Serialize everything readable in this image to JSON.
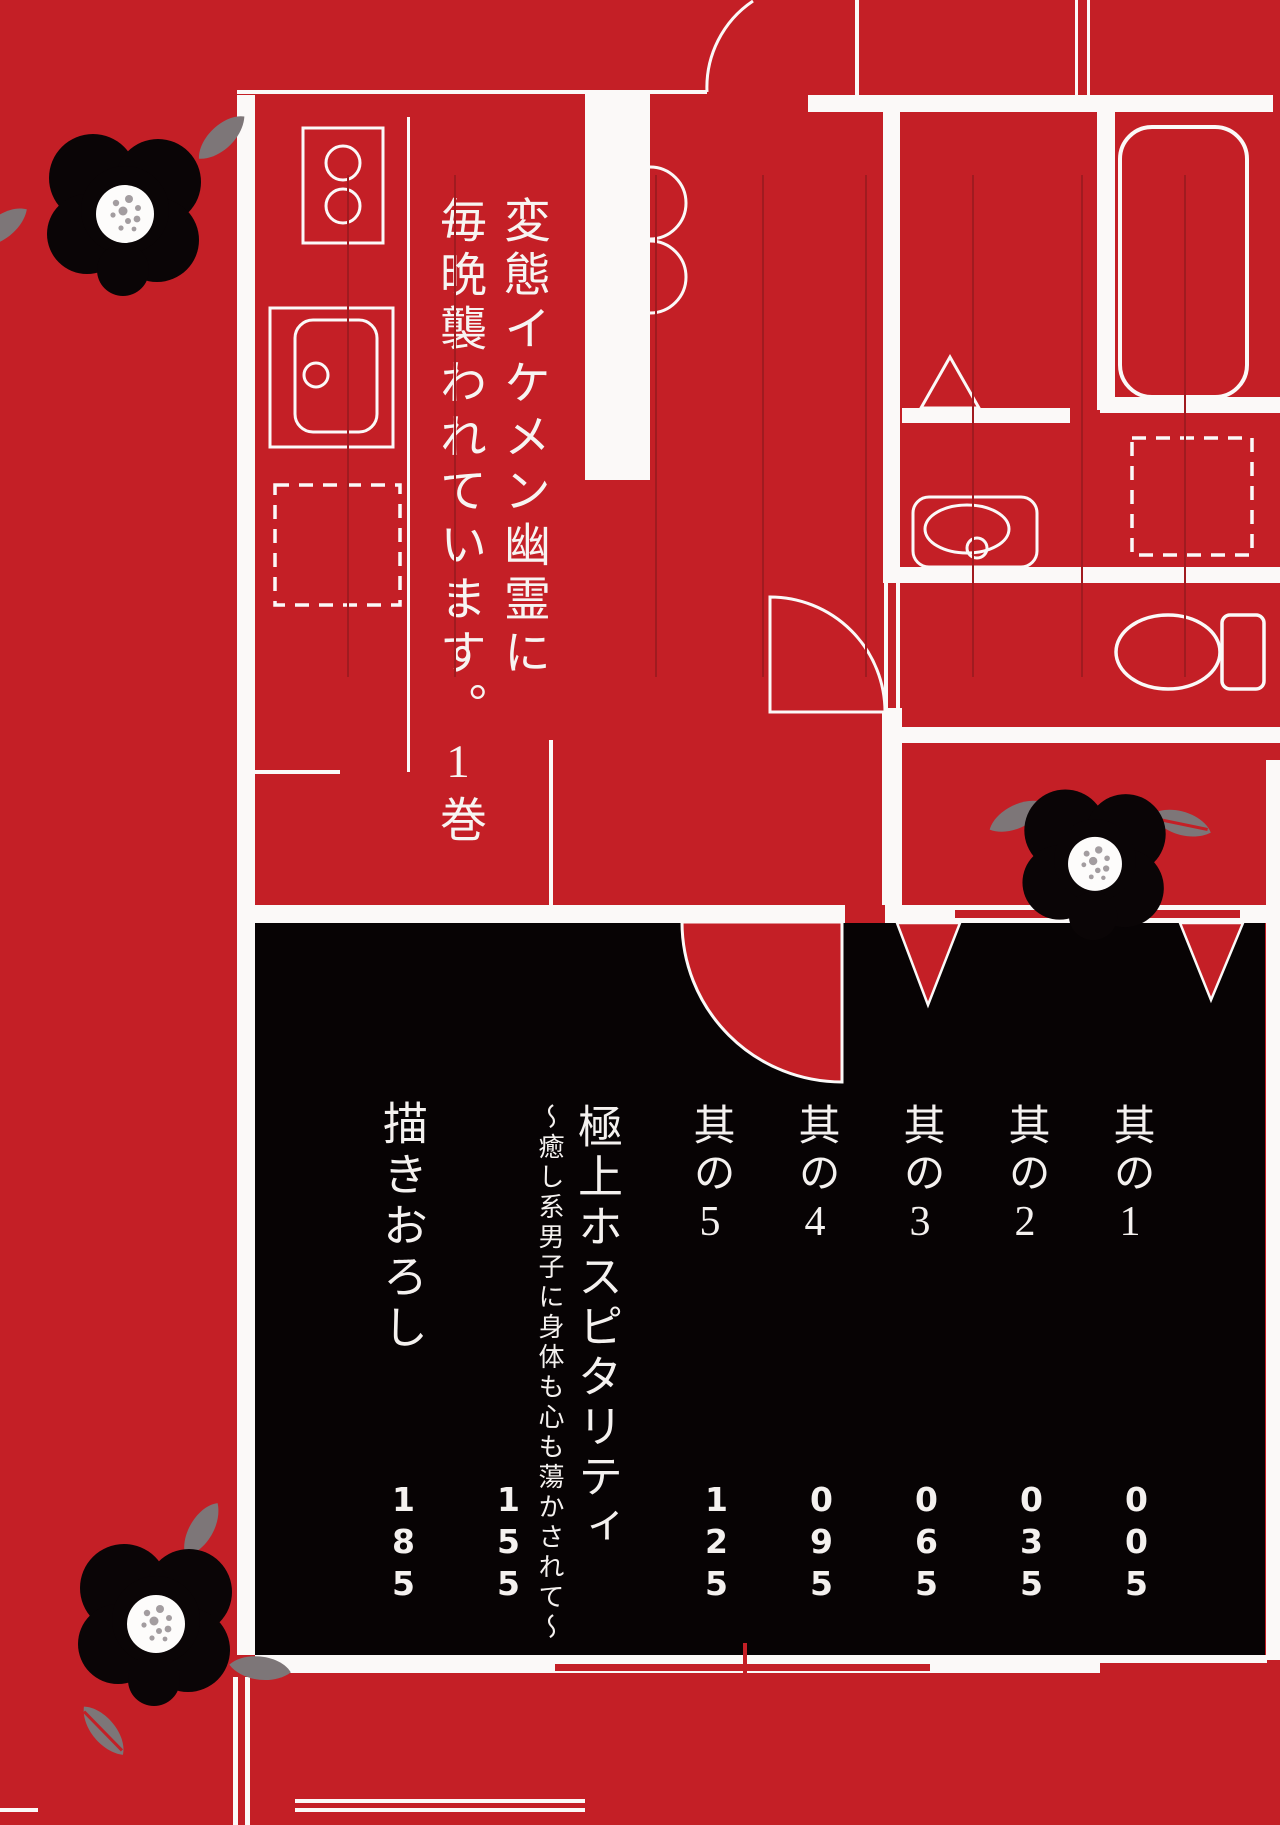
{
  "book": {
    "title_line1": "変態イケメン幽霊に",
    "title_line2": "毎晩襲われています。1巻"
  },
  "toc": {
    "chapters": [
      {
        "label": "其の1",
        "page": "005"
      },
      {
        "label": "其の2",
        "page": "035"
      },
      {
        "label": "其の3",
        "page": "065"
      },
      {
        "label": "其の4",
        "page": "095"
      },
      {
        "label": "其の5",
        "page": "125"
      },
      {
        "label": "極上ホスピタリティ",
        "subtitle": "～癒し系男子に身体も心も蕩かされて～",
        "page": "155"
      },
      {
        "label": "描きおろし",
        "page": "185"
      }
    ]
  },
  "decor": {
    "flower_icon": "camellia-flower",
    "leaf_icon": "camellia-leaf",
    "floorplan_icons": [
      "stove-icon",
      "kitchen-sink-icon",
      "fridge-dashed-icon",
      "closet-folding-door-icon",
      "entry-door-arc-icon",
      "bathtub-icon",
      "washbasin-icon",
      "washer-dashed-icon",
      "toilet-icon",
      "door-swing-fan-icon",
      "door-triangle-icon"
    ]
  },
  "colors": {
    "background_red": "#c41f26",
    "panel_black": "#070304",
    "line_white": "#fbf9f8",
    "toc_rule_red": "#a01b20",
    "leaf_gray": "#7d7678",
    "text_white": "#f4f1ef"
  }
}
